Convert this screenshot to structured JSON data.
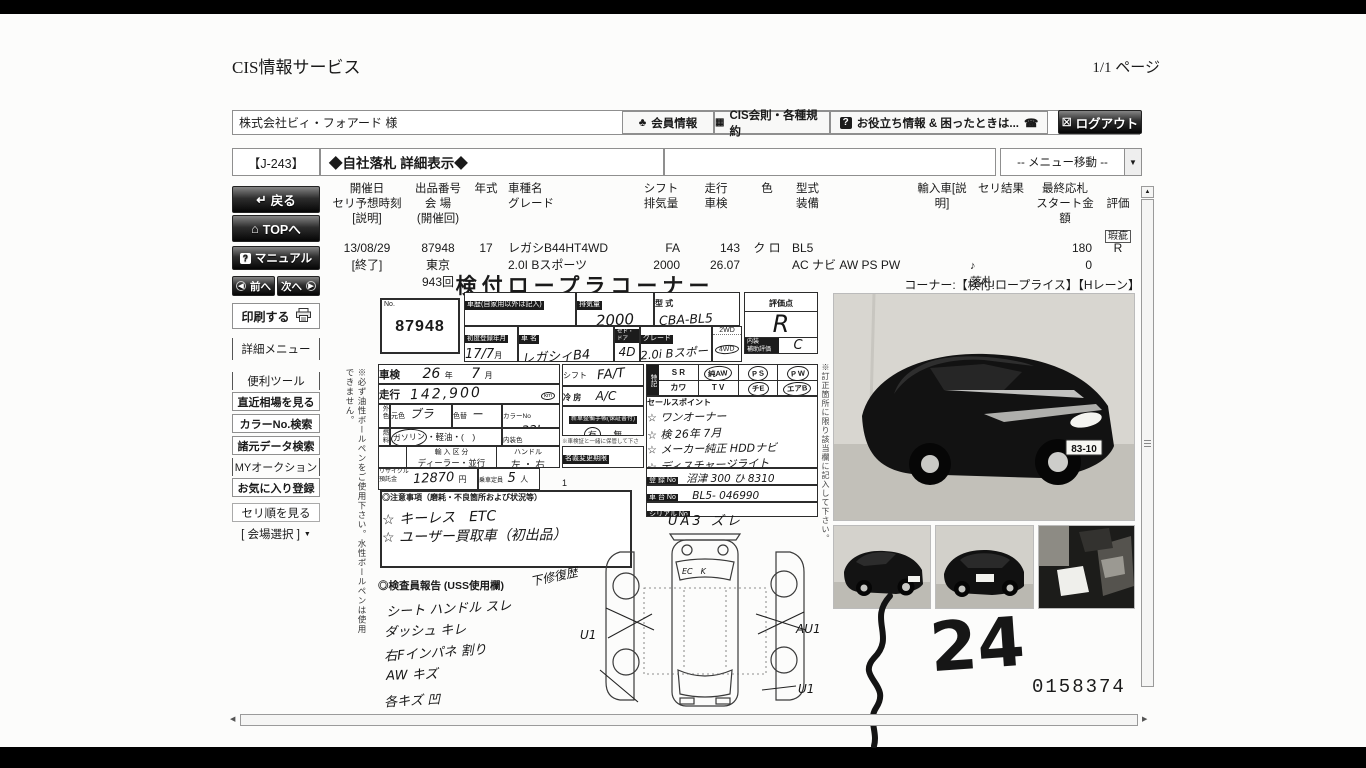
{
  "page": {
    "app_title": "CIS情報サービス",
    "page_indicator": "1/1 ページ"
  },
  "topbar": {
    "company": "株式会社ビィ・フォアード 様",
    "member": "会員情報",
    "rules": "CIS会則・各種規約",
    "help": "お役立ち情報 & 困ったときは...",
    "logout": "ログアウト"
  },
  "titlebar": {
    "code": "【J-243】",
    "title": "◆自社落札 詳細表示◆",
    "menu_move": "-- メニュー移動 --"
  },
  "sidebar": {
    "back": "戻る",
    "top": "TOPへ",
    "manual": "マニュアル",
    "prev": "前へ",
    "next": "次へ",
    "print": "印刷する",
    "detail_menu": "詳細メニュー",
    "tools": "便利ツール",
    "recent_market": "直近相場を見る",
    "color_search": "カラーNo.検索",
    "spec_search": "諸元データ検索",
    "my_auction": "MYオークション",
    "favorite": "お気に入り登録",
    "seri_order": "セリ順を見る",
    "venue_select": "[ 会場選択 ]"
  },
  "table": {
    "headers": [
      "開催日\nセリ予想時刻\n[説明]",
      "出品番号\n会 場\n(開催回)",
      "年式",
      "車種名\nグレード",
      "シフト\n排気量",
      "走行\n車検",
      "色",
      "型式\n装備",
      "輸入車[説明]",
      "セリ結果",
      "最終応札\nスタート金額",
      "評価"
    ],
    "kashi": "瑕疵",
    "row": {
      "date": "13/08/29\n[終了]",
      "lot": "87948\n東京\n943回",
      "year": "17",
      "model": "レガシB44HT4WD\n2.0I Bスポーツ",
      "shift": "FA\n2000",
      "run": "143\n26.07",
      "color": "ク ロ",
      "spec": "BL5\nAC ナビ AW PS PW",
      "import": "",
      "result": "落札",
      "amount": "180\n0",
      "grade": "R"
    }
  },
  "sheet": {
    "title": "検付ロープラコーナー",
    "corner": "コーナー:【検付!ロープライス】【Hレーン】",
    "no_label": "No.",
    "no": "87948",
    "history_label": "車歴(自家用以外は記入)",
    "disp_label": "排気量",
    "disp": "2000",
    "mcode_label": "型 式",
    "mcode": "CBA-BL5",
    "eval_label": "評価点",
    "eval": "R",
    "interior_label": "内装\n補助評価",
    "interior": "C",
    "firstreg_label": "初度登録年月",
    "firstreg": "17/7",
    "month": "月",
    "name_label": "車 名",
    "name": "レガシィB4",
    "body_label": "セド・ドア",
    "body": "4D",
    "grade_label": "グレード",
    "grade": "2.0i Bスポーツ",
    "d2": "2WD",
    "d4": "4WD",
    "shaken_label": "車検",
    "shaken_y": "26",
    "y_unit": "年",
    "shaken_m": "7",
    "m_unit": "月",
    "shift_label": "シフト",
    "shift": "FA/T",
    "run_label": "走行",
    "run": "142,900",
    "km": "km",
    "mile": "マイル",
    "ac_label": "冷 房",
    "ac": "A/C",
    "outcolor_label": "外色",
    "base_label": "元色",
    "base": "ブラ",
    "repaint_label": "色替",
    "repaint": "ー",
    "colorno_label": "カラーNo",
    "colorno": "32J",
    "fuel_label": "燃料",
    "fuel_gas": "ガソリン",
    "fuel_rest": "・軽油・(　)",
    "intcolor_label": "内装色",
    "tokki_label": "特記",
    "tokki1": [
      "S R",
      "純AW",
      "P S",
      "P W"
    ],
    "tokki2": [
      "カワ",
      "T V",
      "チE",
      "エアB"
    ],
    "sales_label": "セールスポイント",
    "sales": [
      "☆ ワンオーナー",
      "☆ 検 26年 7月",
      "☆ メーカー純正 HDDナビ",
      "☆ ディスチャージライト"
    ],
    "notebook_label": "新車整備手帳(保証書付)",
    "notebook_yes": "有",
    "notebook_no": "無",
    "keep_note": "※車検証と一緒に保管して下さい。",
    "transfer_label": "名義変更期限",
    "transfer_val": "月　　日",
    "import_label": "輸 入 区 分",
    "import_val": "ディーラー・並行",
    "handle_label": "ハンドル",
    "handle_val": "左 ・ 右",
    "recycle_label": "リサイクル\n預託金",
    "recycle": "12870",
    "yen": "円",
    "capacity_label": "乗車定員",
    "capacity": "5",
    "nin": "人",
    "load": "1",
    "regno_label": "登 録 No",
    "regno": "沼津 300 ひ 8310",
    "chassis_label": "車 台 No",
    "chassis": "BL5- 046990",
    "serial_label": "シリアル No",
    "caution_label": "◎注意事項（磨耗・不良箇所および状況等）",
    "cautions": [
      "☆ キーレス　ETC",
      "☆ ユーザー買取車（初出品）"
    ],
    "inspector_label": "◎検査員報告 (USS使用欄)",
    "repair_note": "下修復歴",
    "inspector_notes": [
      "シート ハンドル スレ",
      "ダッシュ キレ",
      "右Fインパネ 割り",
      "AW キズ",
      "各キズ 凹"
    ],
    "diag_top": "UA3 ズレ",
    "diag_left": "U1",
    "diag_right": "AU1",
    "diag_bottom": "U1",
    "diag_ec": "EC　K",
    "left_note": "※必ず油性ボールペンをご使用下さい。水性ボールペンは使用できません。",
    "right_note": "※訂正箇所に限り該当欄に記入して下さい。",
    "big_number": "24",
    "serial_print": "0158374"
  },
  "photos": {
    "plate": "83-10"
  },
  "icons": {
    "member": "♣",
    "rules": "▦",
    "help": "?",
    "phone": "☎",
    "logout": "☒",
    "back": "↵",
    "home": "⌂",
    "manual": "?",
    "prev": "◀",
    "next": "▶",
    "dropdown": "▼",
    "result": "♪",
    "up": "▲",
    "left": "◀",
    "right": "▶"
  }
}
